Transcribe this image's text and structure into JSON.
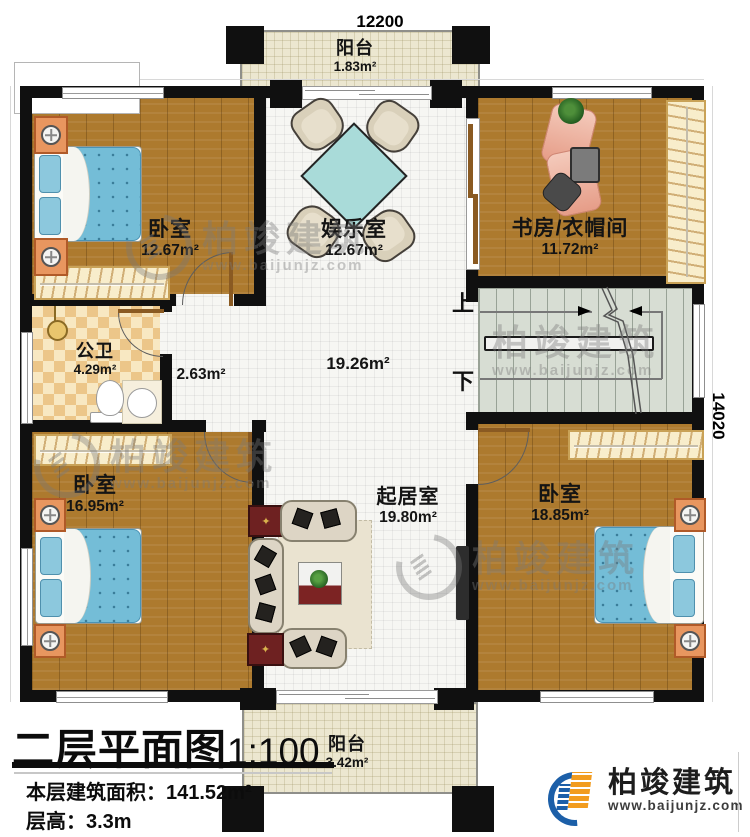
{
  "meta": {
    "title": "二层平面图",
    "scale": "1:100",
    "area_label": "本层建筑面积：",
    "area_value": "141.52m²",
    "height_label": "层高：",
    "height_value": "3.3m"
  },
  "dimensions": {
    "width_mm": "12200",
    "height_mm": "14020"
  },
  "stairs": {
    "up": "上",
    "down": "下"
  },
  "rooms": {
    "balcony_top": {
      "name": "阳台",
      "area": "1.83m²"
    },
    "bedroom_tl": {
      "name": "卧室",
      "area": "12.67m²"
    },
    "entertainment": {
      "name": "娱乐室",
      "area": "12.67m²"
    },
    "study": {
      "name": "书房/衣帽间",
      "area": "11.72m²"
    },
    "bathroom": {
      "name": "公卫",
      "area": "4.29m²"
    },
    "corridor": {
      "area": "2.63m²"
    },
    "hall": {
      "area": "19.26m²"
    },
    "living": {
      "name": "起居室",
      "area": "19.80m²"
    },
    "bedroom_bl": {
      "name": "卧室",
      "area": "16.95m²"
    },
    "bedroom_br": {
      "name": "卧室",
      "area": "18.85m²"
    },
    "balcony_bottom": {
      "name": "阳台",
      "area": "3.42m²"
    }
  },
  "brand": {
    "name": "柏竣建筑",
    "website": "www.baijunjz.com"
  },
  "colors": {
    "wall": "#111111",
    "wood_floor": "#ad7a2e",
    "bed_blue": "#74bdd7",
    "stair_floor": "#d7ddd3",
    "balcony_floor": "#ece7d0",
    "bath_tile": "#ecc689",
    "logo_blue": "#1c5fa8",
    "logo_orange": "#f29c1f"
  }
}
